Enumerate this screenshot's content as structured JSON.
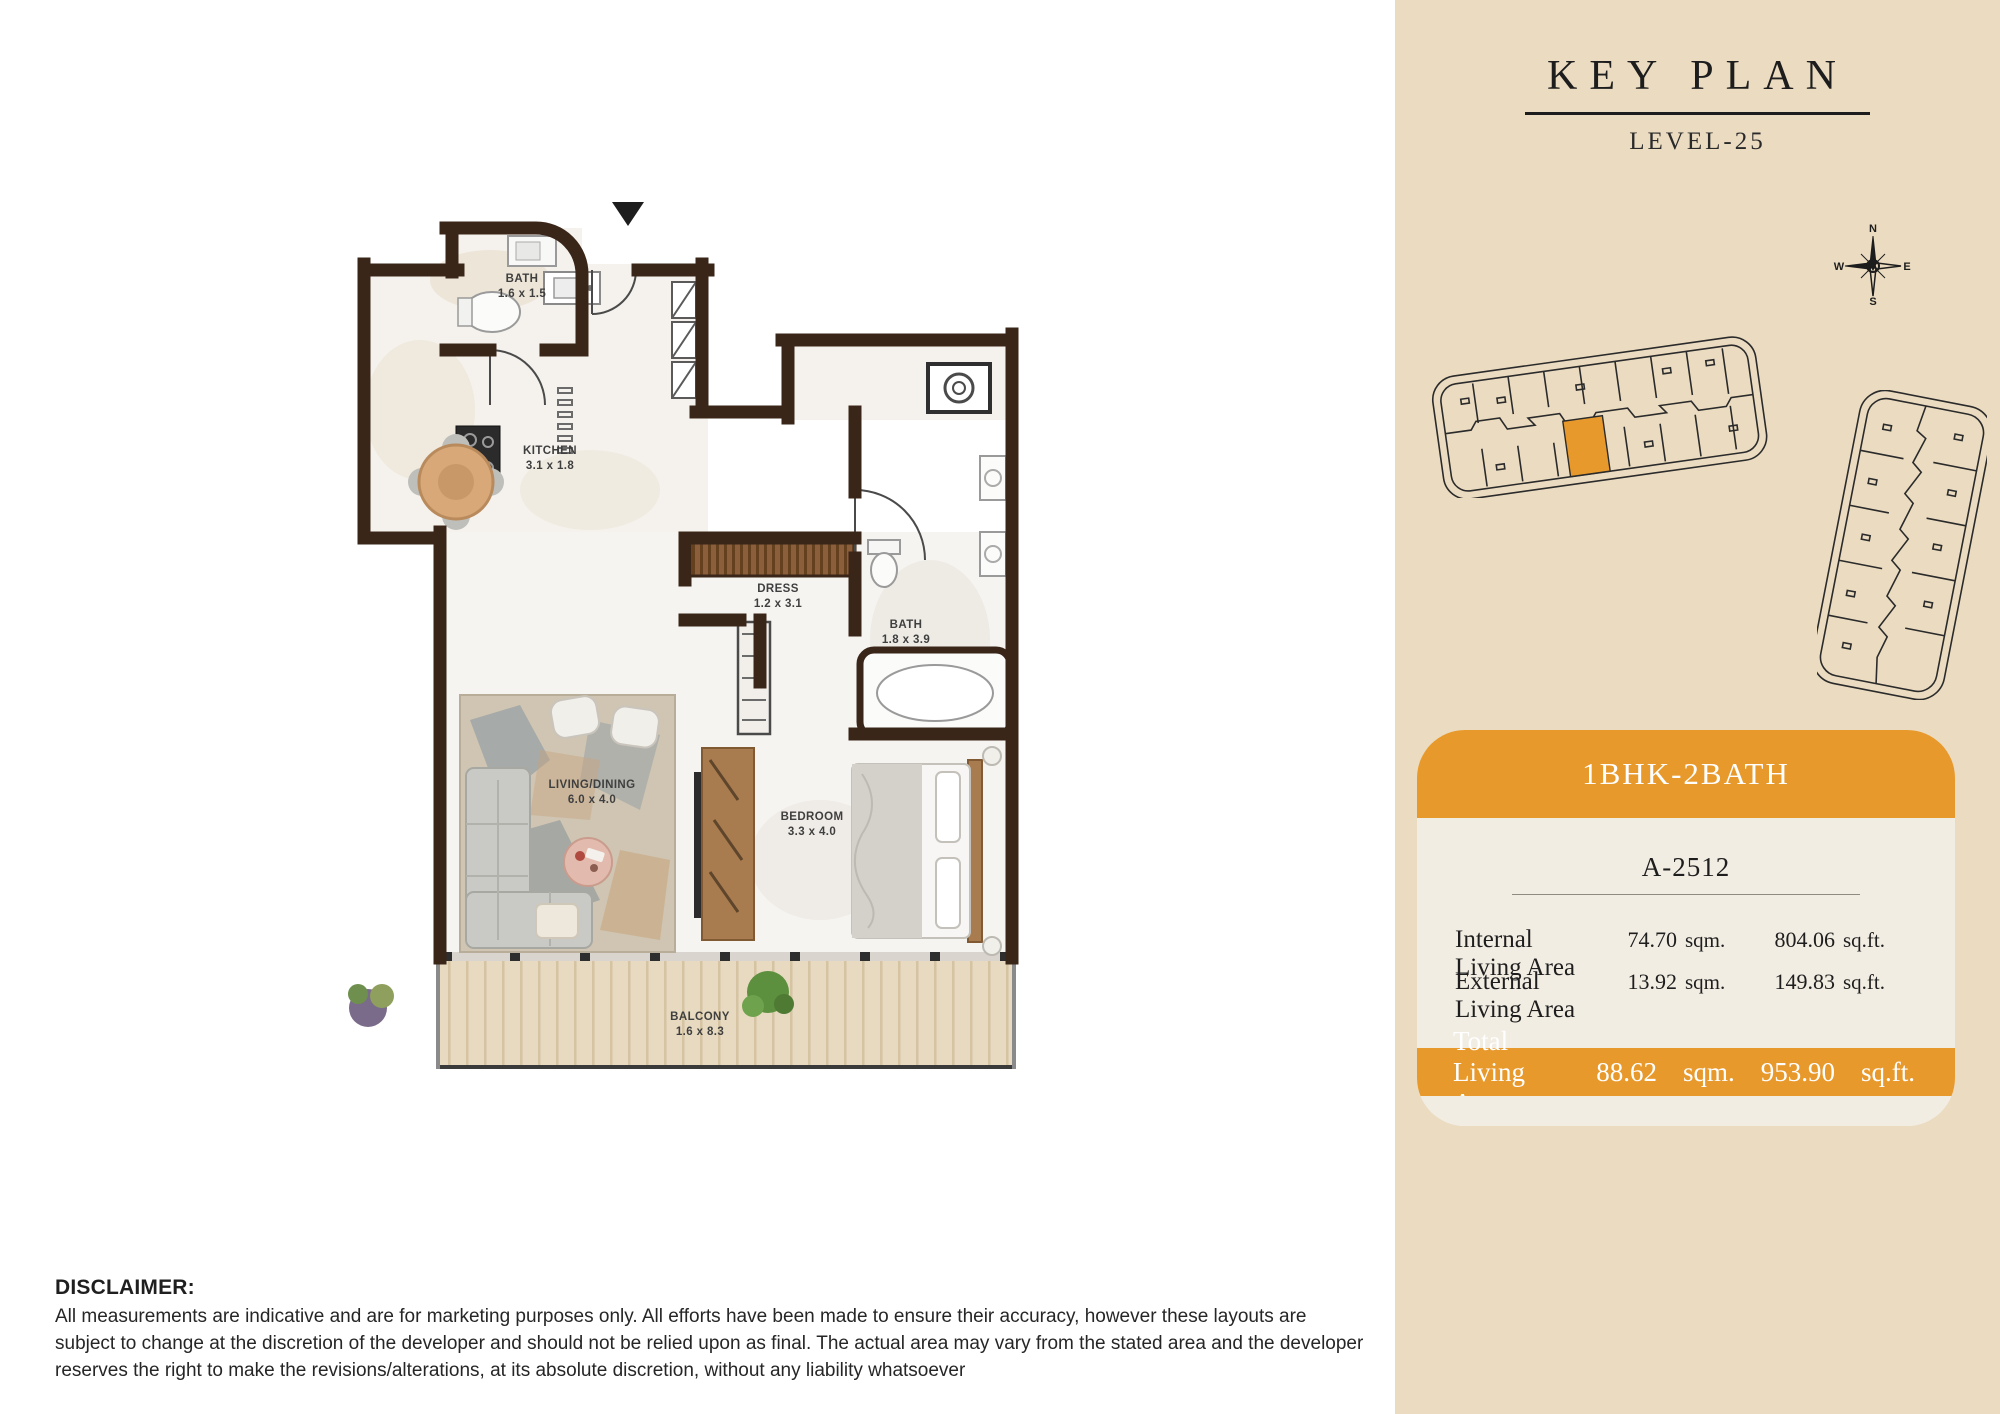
{
  "sidebar": {
    "title": "KEY PLAN",
    "level": "LEVEL-25",
    "compass": {
      "n": "N",
      "e": "E",
      "s": "S",
      "w": "W"
    },
    "unit_type": "1BHK-2BATH",
    "unit_number": "A-2512",
    "areas": [
      {
        "label": "Internal Living Area",
        "sqm": "74.70",
        "sqm_unit": "sqm.",
        "sqft": "804.06",
        "sqft_unit": "sq.ft."
      },
      {
        "label": "External Living Area",
        "sqm": "13.92",
        "sqm_unit": "sqm.",
        "sqft": "149.83",
        "sqft_unit": "sq.ft."
      }
    ],
    "total": {
      "label": "Total Living Area",
      "sqm": "88.62",
      "sqm_unit": "sqm.",
      "sqft": "953.90",
      "sqft_unit": "sq.ft."
    }
  },
  "floor_plan": {
    "rooms": [
      {
        "name": "BATH",
        "dims": "1.6 x 1.5"
      },
      {
        "name": "KITCHEN",
        "dims": "3.1 x 1.8"
      },
      {
        "name": "DRESS",
        "dims": "1.2 x 3.1"
      },
      {
        "name": "BATH",
        "dims": "1.8 x 3.9"
      },
      {
        "name": "LIVING/DINING",
        "dims": "6.0 x 4.0"
      },
      {
        "name": "BEDROOM",
        "dims": "3.3 x 4.0"
      },
      {
        "name": "BALCONY",
        "dims": "1.6 x 8.3"
      }
    ]
  },
  "disclaimer": {
    "heading": "DISCLAIMER:",
    "body": "All measurements are indicative and are for marketing purposes only. All efforts have been made to ensure their accuracy, however these layouts are subject to change at the discretion of the developer and should not be relied upon as final. The actual area may vary from the stated area and the developer reserves the right to make the revisions/alterations, at its absolute discretion, without any liability whatsoever"
  },
  "colors": {
    "accent_orange": "#E8992C",
    "sidebar_bg": "#EBDCC1",
    "card_bg": "#F2EDE3",
    "wall_brown": "#3A2619",
    "text_dark": "#1d1d1d"
  }
}
